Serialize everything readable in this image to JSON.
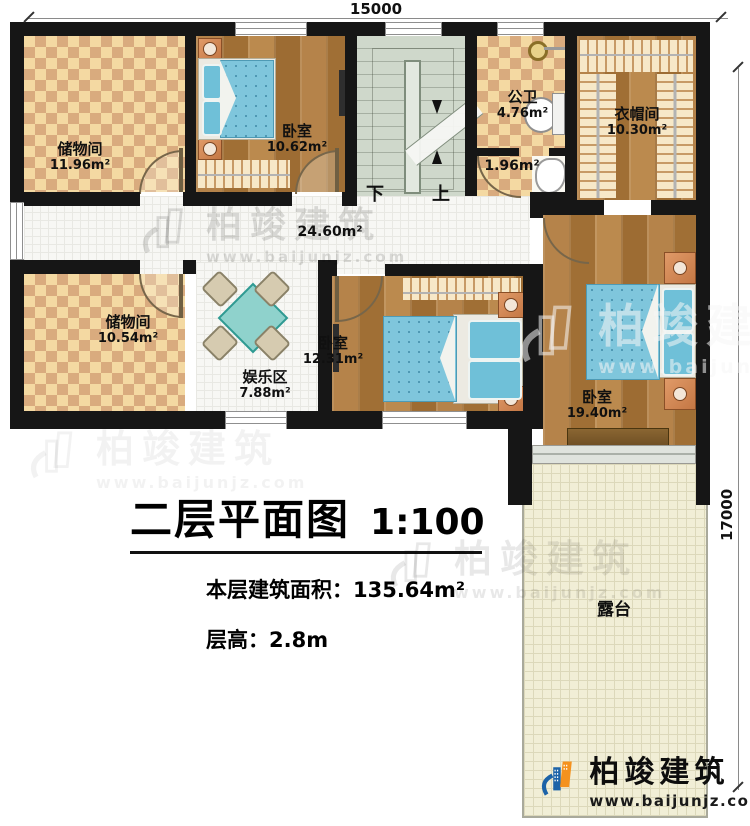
{
  "meta": {
    "dim_top": "15000",
    "dim_right": "17000"
  },
  "rooms": {
    "storage1": {
      "name": "储物间",
      "area": "11.96m²"
    },
    "bedroom1": {
      "name": "卧室",
      "area": "10.62m²"
    },
    "bath": {
      "name": "公卫",
      "area": "4.76m²"
    },
    "bath_small": {
      "area": "1.96m²"
    },
    "cloakroom": {
      "name": "衣帽间",
      "area": "10.30m²"
    },
    "hall": {
      "area": "24.60m²"
    },
    "storage2": {
      "name": "储物间",
      "area": "10.54m²"
    },
    "fun": {
      "name": "娱乐区",
      "area": "7.88m²"
    },
    "bedroom2": {
      "name": "卧室",
      "area": "12.31m²"
    },
    "bedroom3": {
      "name": "卧室",
      "area": "19.40m²"
    },
    "terrace": {
      "name": "露台"
    }
  },
  "stairs": {
    "down": "下",
    "up": "上"
  },
  "title": {
    "text": "二层平面图",
    "scale": "1:100",
    "area_label": "本层建筑面积：135.64m²",
    "height_label": "层高：2.8m"
  },
  "watermark": {
    "brand": "柏竣建筑",
    "url": "www.baijunjz.com"
  },
  "logo": {
    "brand": "柏竣建筑",
    "url": "www.baijunjz.com"
  },
  "colors": {
    "wall": "#161616",
    "checker": "#d9ab7e",
    "wood": "#ac7a3d",
    "bed_teal": "#7fc6dc",
    "stairs": "#cfd8cb",
    "terrace": "#f1eed6",
    "logo_blue": "#1c63a8",
    "logo_orange": "#f5921e"
  }
}
